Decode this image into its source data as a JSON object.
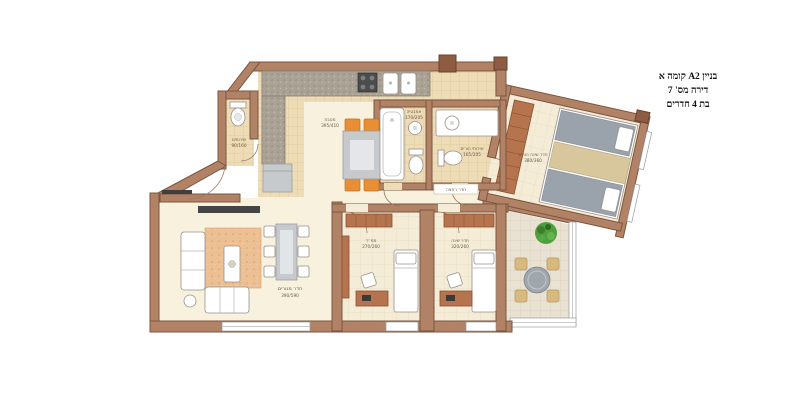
{
  "title_block": {
    "line1": "בניין A2 קומה א",
    "line2": "דירה מס' 7",
    "line3": "בת 4 חדרים"
  },
  "rooms": {
    "kitchen": {
      "name": "מטבח",
      "dims": "395/410"
    },
    "living_room": {
      "name": "חדר מגורים",
      "dims": "390/590"
    },
    "master_bedroom": {
      "name": "חדר שינה הורים",
      "dims": "380/360"
    },
    "safe_room": {
      "name": "ממ״ד",
      "dims": "270/260"
    },
    "bedroom": {
      "name": "חדר שינה",
      "dims": "320/260"
    },
    "guest_wc": {
      "name": "שירותים",
      "dims": "90/160"
    },
    "bathroom": {
      "name": "אמבטיה",
      "dims": "170/205"
    },
    "parents_wc": {
      "name": "שירותי הורים",
      "dims": "165/205"
    },
    "bath_tag": "חדר רחצה"
  },
  "colors": {
    "wall": "#b28267",
    "floor": "#f8f1de",
    "tile": "#eddcb6",
    "accent_orange": "#e88f35",
    "wood": "#b5744d",
    "plant_green": "#4f9f3c",
    "terrace_floor": "#e9e1d1"
  }
}
